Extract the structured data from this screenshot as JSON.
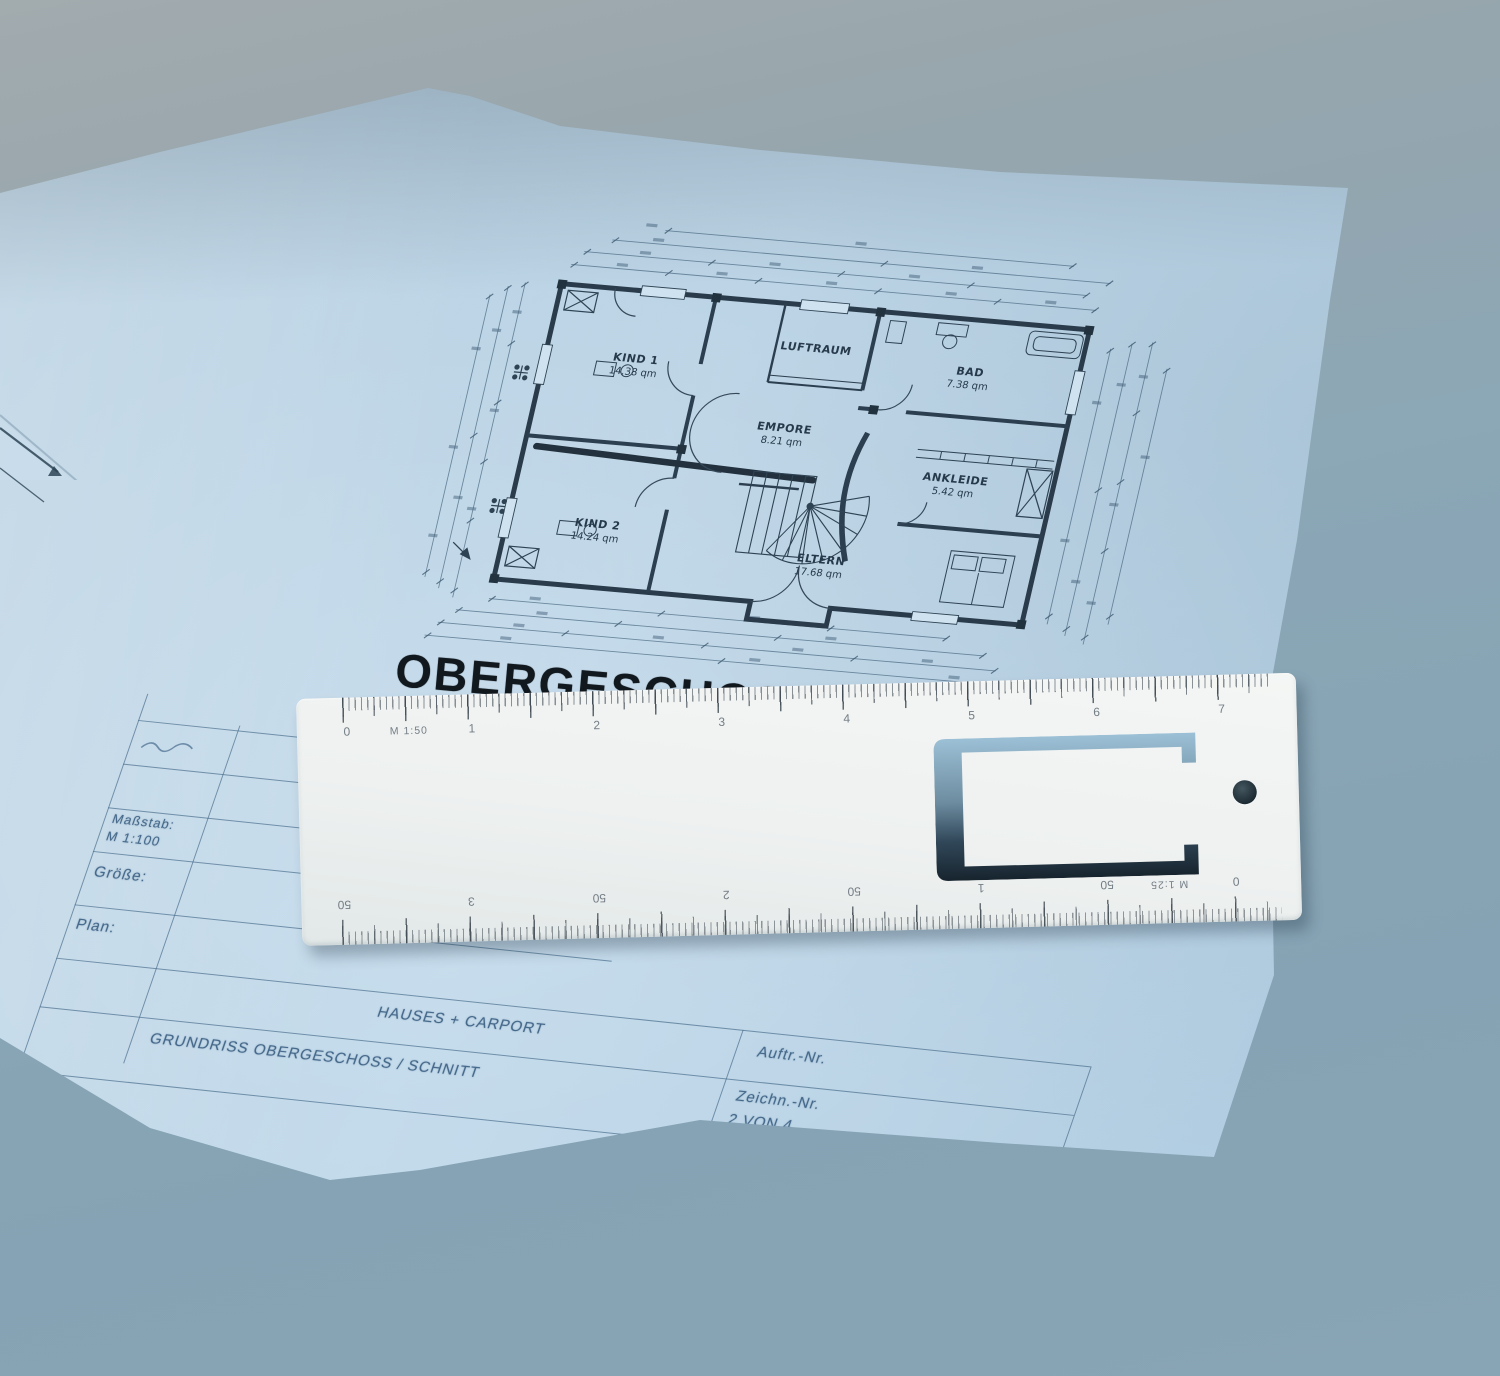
{
  "blueprint": {
    "title": "OBERGESCHOSS",
    "rooms": [
      {
        "name": "KIND 1",
        "area": "14.38 qm"
      },
      {
        "name": "KIND 2",
        "area": "14.24 qm"
      },
      {
        "name": "LUFTRAUM",
        "area": ""
      },
      {
        "name": "EMPORE",
        "area": "8.21 qm"
      },
      {
        "name": "BAD",
        "area": "7.38 qm"
      },
      {
        "name": "ANKLEIDE",
        "area": "5.42 qm"
      },
      {
        "name": "ELTERN",
        "area": "17.68 qm"
      }
    ],
    "title_block": {
      "scale_label": "Maßstab:",
      "scale_value": "M 1:100",
      "size_label": "Größe:",
      "plan_label": "Plan:",
      "project_line": "HAUSES + CARPORT",
      "plan_line": "GRUNDRISS OBERGESCHOSS / SCHNITT",
      "order_label": "Auftr.-Nr.",
      "sheet_label": "Zeichn.-Nr.",
      "sheet_value": "2 VON 4"
    }
  },
  "ruler": {
    "top_scale_label": "M 1:50",
    "top_numbers": [
      "0",
      "1",
      "2",
      "3",
      "4",
      "5",
      "6",
      "7"
    ],
    "bottom_scale_label": "M 1:25",
    "bottom_numbers": [
      "50",
      "3",
      "50",
      "2",
      "50",
      "1",
      "50",
      "0"
    ]
  },
  "colors": {
    "desk": "#8ba7b6",
    "paper": "#b9d3e5",
    "ruler": "#f0f2f1",
    "plan_ink": "#2e4354",
    "title_ink": "#11181e",
    "table_ink": "#46698b"
  }
}
